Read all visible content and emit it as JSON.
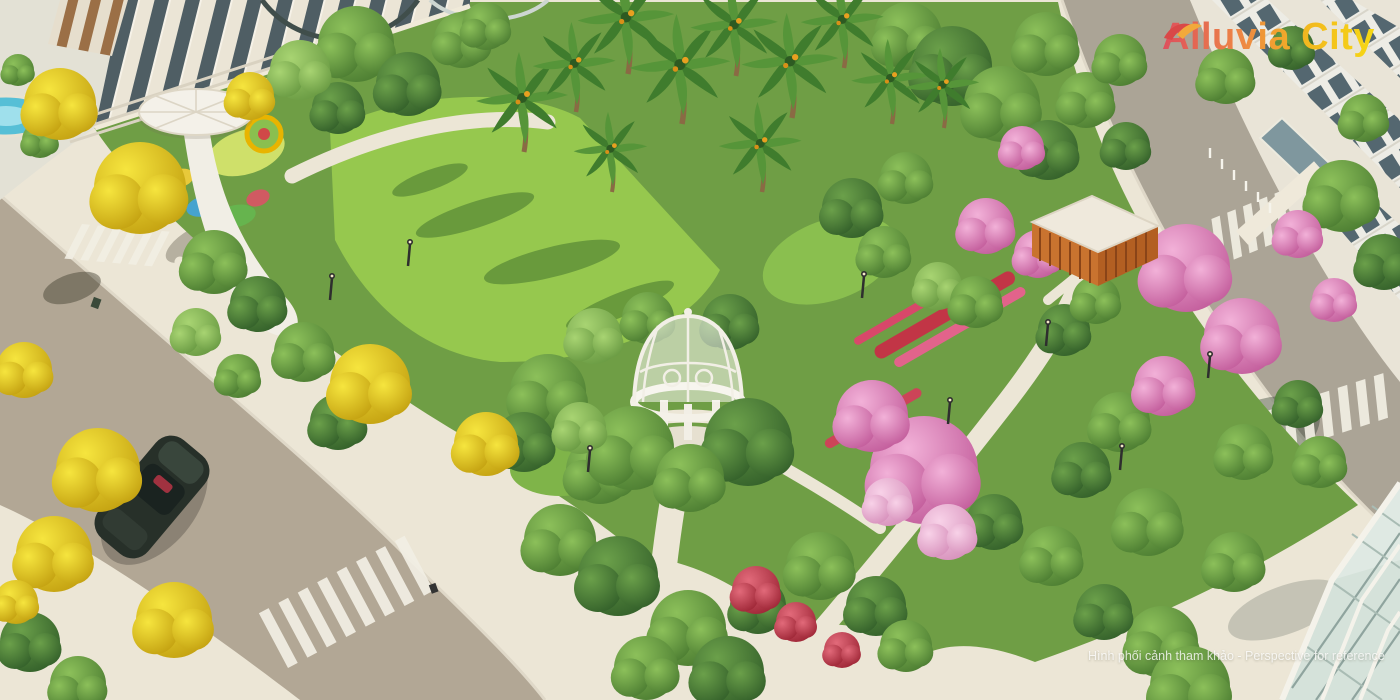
{
  "branding": {
    "name": "Alluvia City"
  },
  "watermark": {
    "text": "Hình phối cảnh tham khảo - Perspective for reference"
  },
  "scene": {
    "description": "Aerial 3D perspective rendering of a landscaped corner park with a white dome gazebo, palm trees, yellow and pink flowering trees, playground, orange pavilion, surrounding streets with zebra crossings, a parked car and neighbouring shophouses",
    "colors": {
      "road": "#b2a795",
      "pavement": "#ece6d6",
      "lawn": "#96c84e",
      "foliage": "#5f9040",
      "yellow_blossom": "#ecd321",
      "pink_blossom": "#df8cc1",
      "red_flowers": "#c23546",
      "structure_white": "#f4f1e8",
      "pavilion_orange": "#c9732f",
      "pond_blue": "#56bfd6",
      "logo_gradient_start": "#dd4f5e",
      "logo_gradient_mid": "#ee8843",
      "logo_gradient_end": "#f6d813"
    }
  }
}
